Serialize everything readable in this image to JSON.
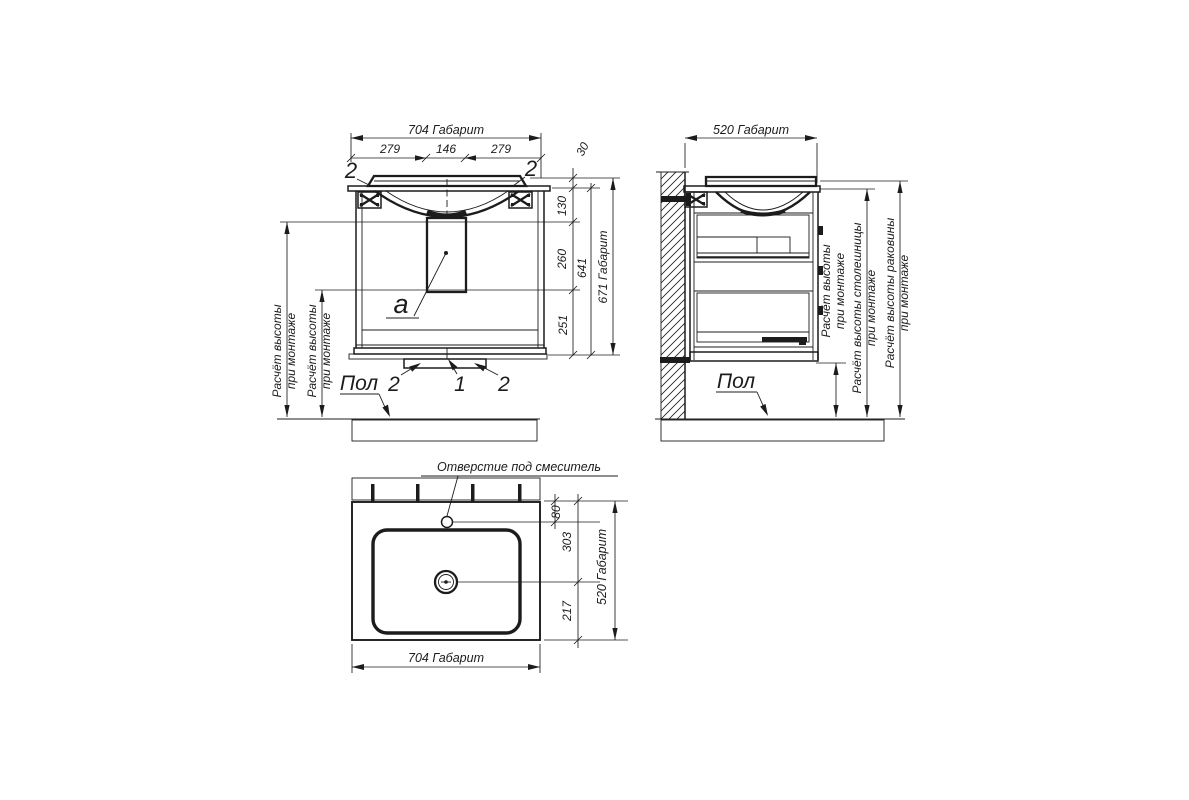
{
  "drawing": {
    "front_view": {
      "dim_width_total": "704 Габарит",
      "dim_w1": "279",
      "dim_w2": "146",
      "dim_w3": "279",
      "dim_rim": "30",
      "dim_h1": "130",
      "dim_h2": "260",
      "dim_h3": "251",
      "dim_h4": "641",
      "dim_height_total": "671 Габарит",
      "callout_2": "2",
      "callout_1": "1",
      "callout_section": "а",
      "floor_label": "Пол",
      "mount_note_l1": "Расчёт высоты",
      "mount_note_l2": "при монтаже"
    },
    "side_view": {
      "dim_depth_total": "520 Габарит",
      "floor_label": "Пол",
      "mount_note_l1": "Расчёт высоты",
      "mount_note_l2": "при монтаже",
      "countertop_note_l1": "Расчёт высоты столешницы",
      "countertop_note_l2": "при монтаже",
      "basin_note_l1": "Расчёт высоты раковины",
      "basin_note_l2": "при монтаже"
    },
    "plan_view": {
      "faucet_hole_label": "Отверстие под смеситель",
      "dim_faucet": "80",
      "dim_drain_back": "303",
      "dim_drain_front": "217",
      "dim_depth_total": "520 Габарит",
      "dim_width_total": "704 Габарит"
    }
  }
}
